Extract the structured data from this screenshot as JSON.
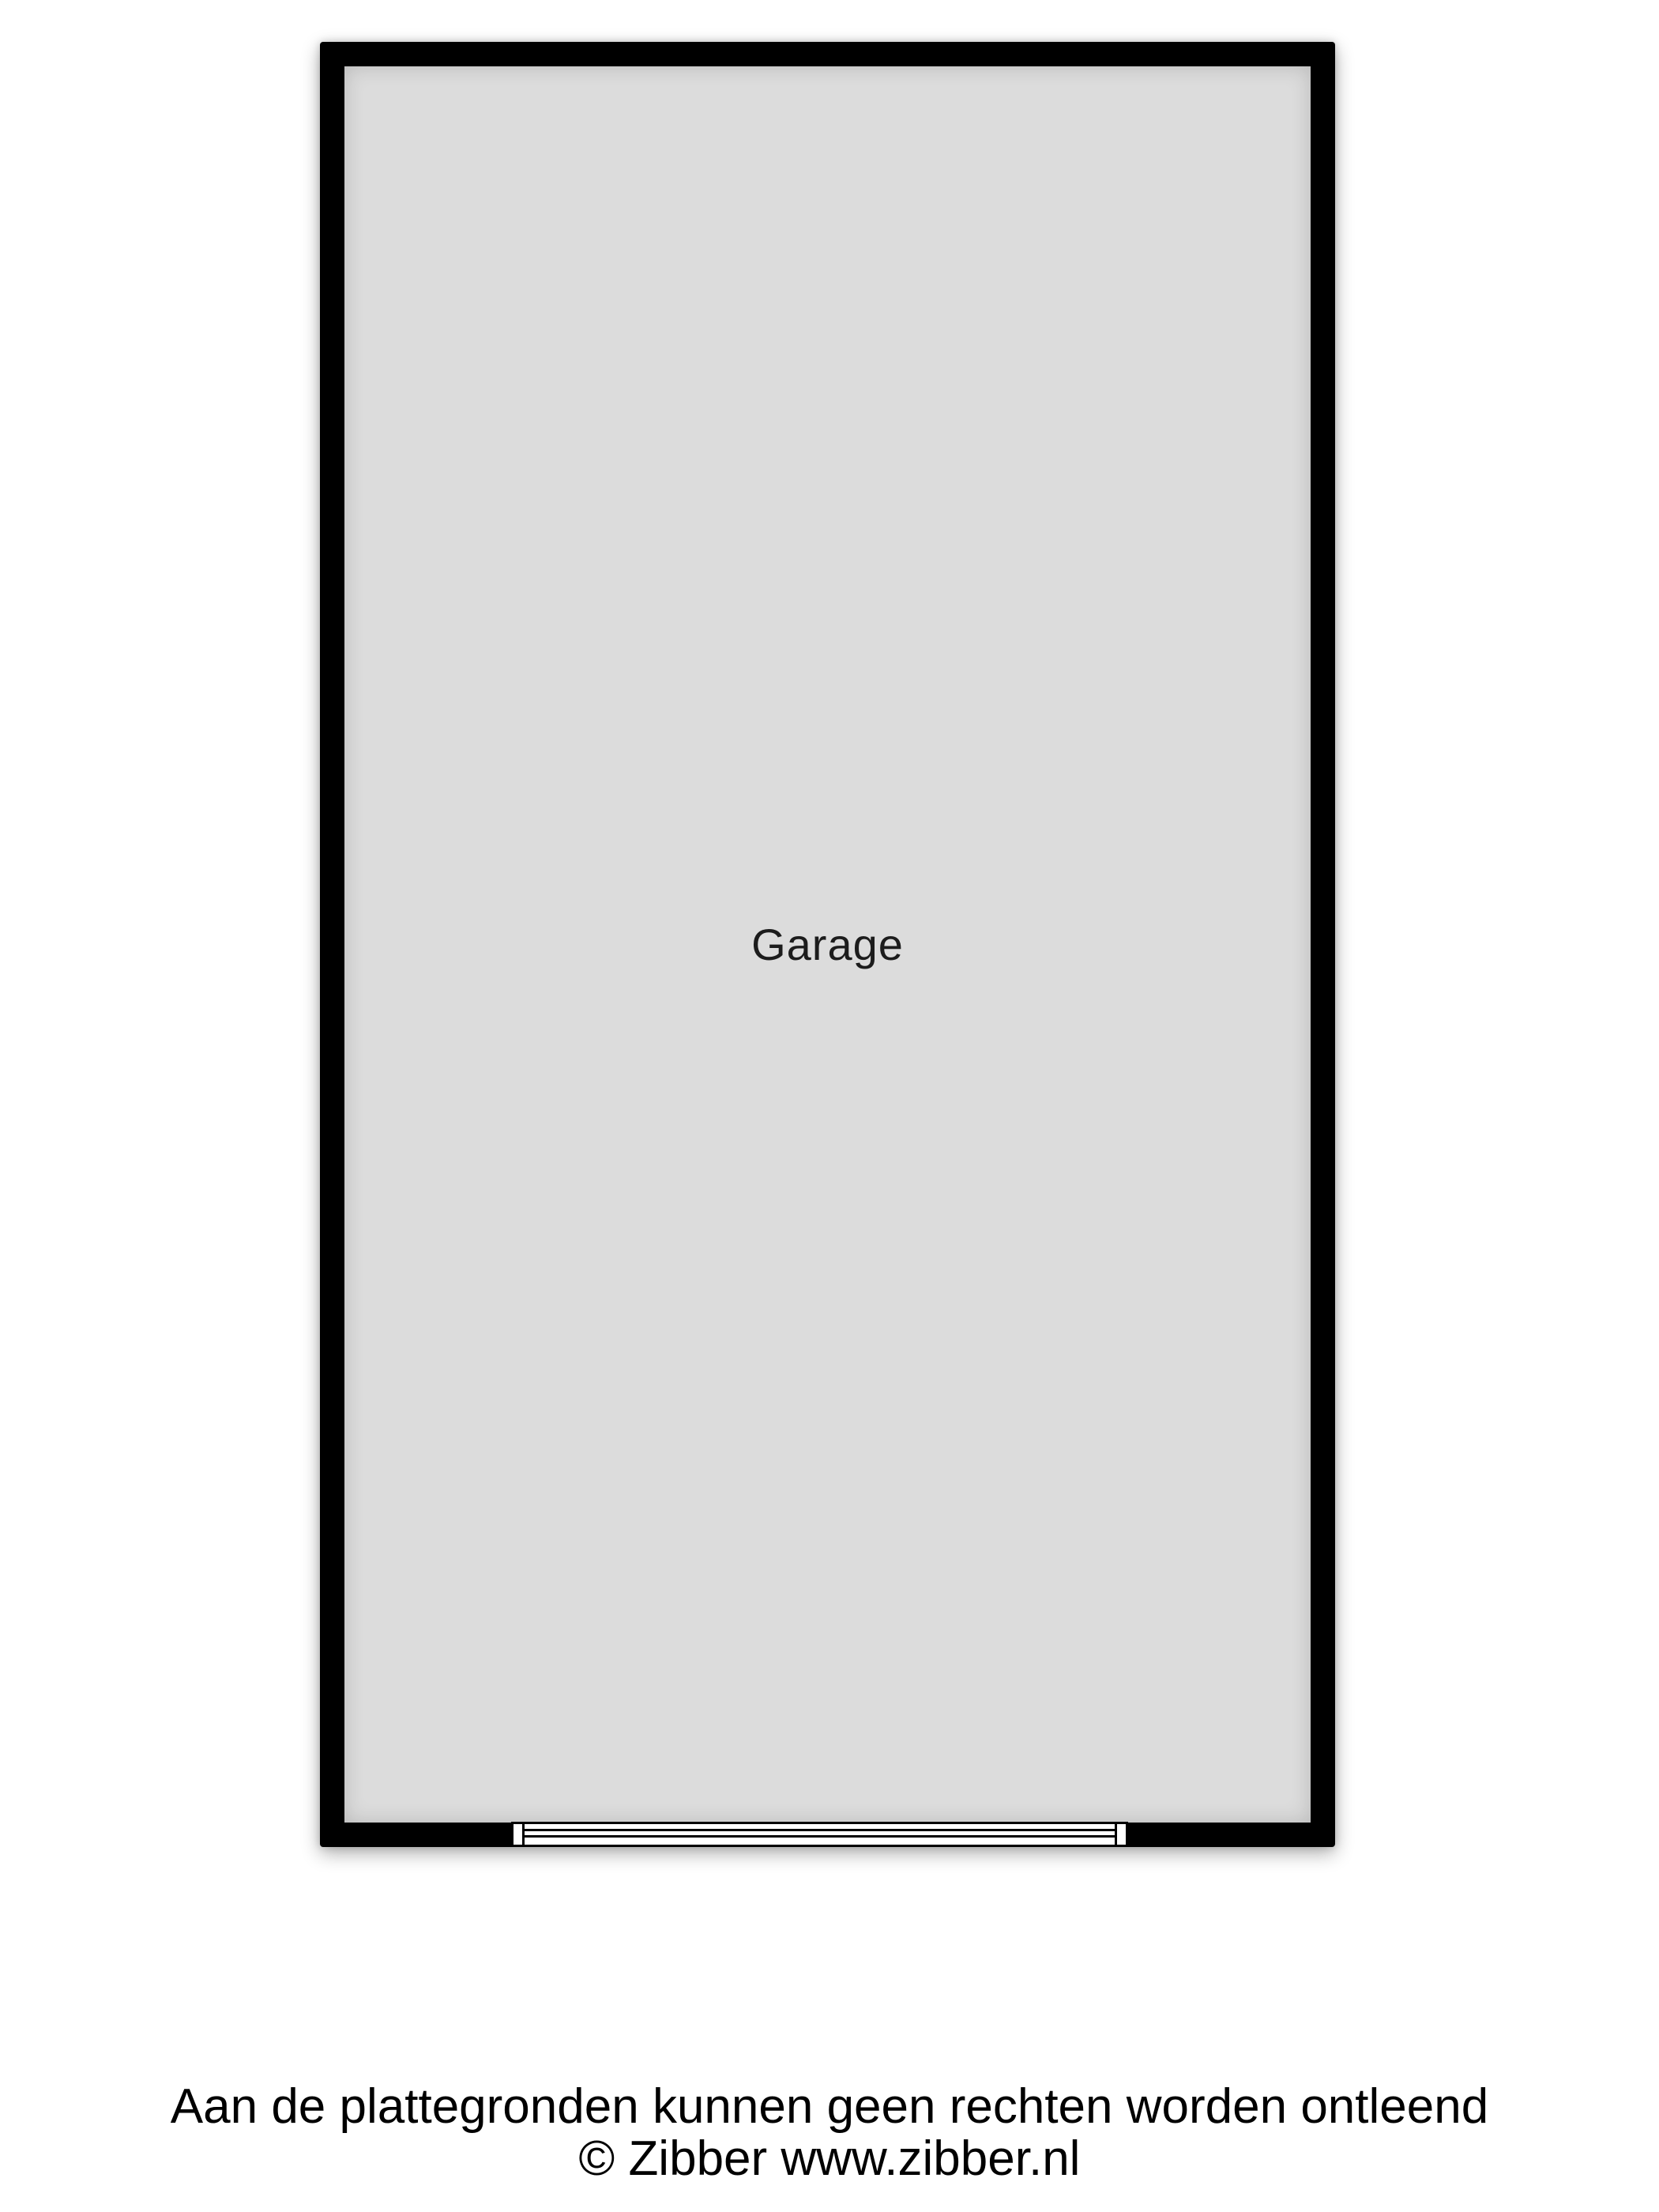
{
  "floorplan": {
    "room": {
      "label": "Garage"
    },
    "door": {
      "symbol": "garage-door"
    },
    "colors": {
      "wall": "#000000",
      "floor": "#dcdcdc",
      "label_text": "#1c1c1c",
      "page_background": "#ffffff"
    }
  },
  "footer": {
    "disclaimer": "Aan de plattegronden kunnen geen rechten worden ontleend",
    "copyright": "© Zibber www.zibber.nl"
  }
}
